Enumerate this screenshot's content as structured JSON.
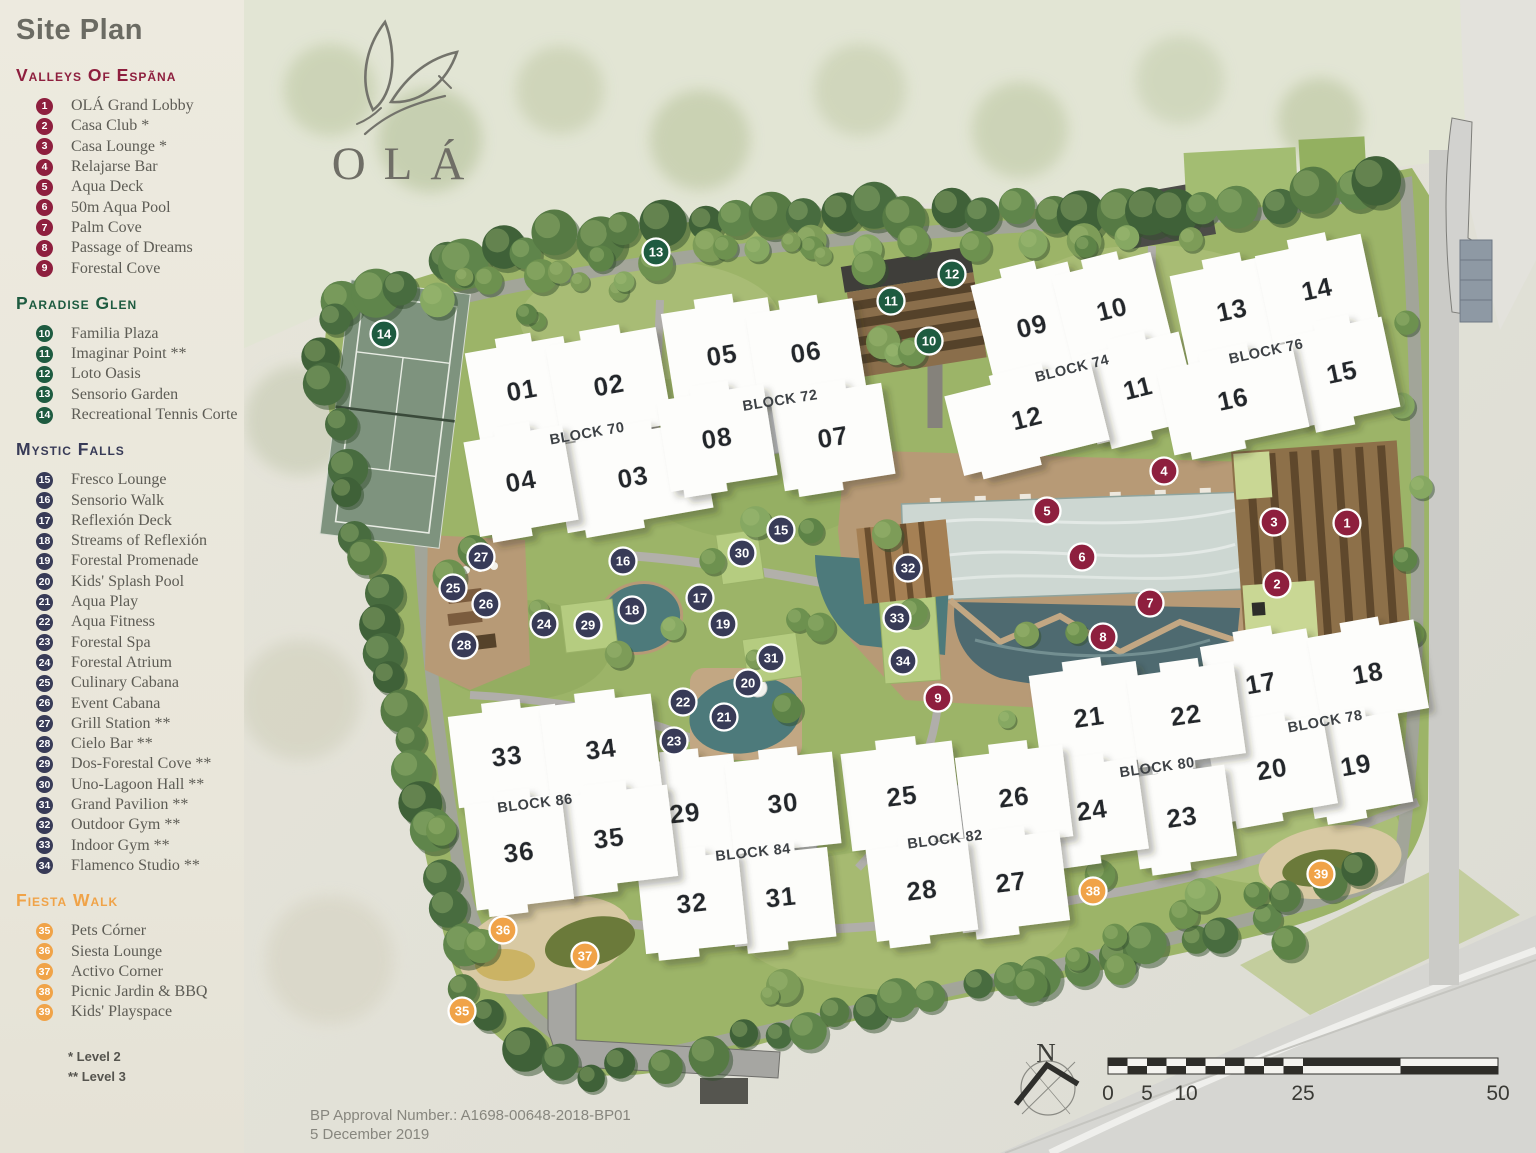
{
  "title": "Site Plan",
  "logo": {
    "name": "OLÁ"
  },
  "legend": {
    "sections": [
      {
        "id": "valleys",
        "title": "Valleys Of Espãna",
        "color": "#8e1f3e",
        "items": [
          {
            "n": "1",
            "label": "OLÁ Grand Lobby"
          },
          {
            "n": "2",
            "label": "Casa Club *"
          },
          {
            "n": "3",
            "label": "Casa Lounge *"
          },
          {
            "n": "4",
            "label": "Relajarse Bar"
          },
          {
            "n": "5",
            "label": "Aqua Deck"
          },
          {
            "n": "6",
            "label": "50m Aqua Pool"
          },
          {
            "n": "7",
            "label": "Palm Cove"
          },
          {
            "n": "8",
            "label": "Passage of Dreams"
          },
          {
            "n": "9",
            "label": "Forestal Cove"
          }
        ]
      },
      {
        "id": "paradise",
        "title": "Paradise Glen",
        "color": "#1e5b40",
        "items": [
          {
            "n": "10",
            "label": "Familia Plaza"
          },
          {
            "n": "11",
            "label": "Imaginar Point **"
          },
          {
            "n": "12",
            "label": "Loto Oasis"
          },
          {
            "n": "13",
            "label": "Sensorio Garden"
          },
          {
            "n": "14",
            "label": "Recreational Tennis Corte"
          }
        ]
      },
      {
        "id": "mystic",
        "title": "Mystic Falls",
        "color": "#383b57",
        "items": [
          {
            "n": "15",
            "label": "Fresco Lounge"
          },
          {
            "n": "16",
            "label": "Sensorio Walk"
          },
          {
            "n": "17",
            "label": "Reflexión Deck"
          },
          {
            "n": "18",
            "label": "Streams of Reflexión"
          },
          {
            "n": "19",
            "label": "Forestal Promenade"
          },
          {
            "n": "20",
            "label": "Kids' Splash Pool"
          },
          {
            "n": "21",
            "label": "Aqua Play"
          },
          {
            "n": "22",
            "label": "Aqua Fitness"
          },
          {
            "n": "23",
            "label": "Forestal Spa"
          },
          {
            "n": "24",
            "label": "Forestal Atrium"
          },
          {
            "n": "25",
            "label": "Culinary Cabana"
          },
          {
            "n": "26",
            "label": "Event Cabana"
          },
          {
            "n": "27",
            "label": "Grill Station **"
          },
          {
            "n": "28",
            "label": "Cielo Bar **"
          },
          {
            "n": "29",
            "label": "Dos-Forestal Cove **"
          },
          {
            "n": "30",
            "label": "Uno-Lagoon Hall **"
          },
          {
            "n": "31",
            "label": "Grand Pavilion **"
          },
          {
            "n": "32",
            "label": "Outdoor Gym **"
          },
          {
            "n": "33",
            "label": "Indoor Gym **"
          },
          {
            "n": "34",
            "label": "Flamenco Studio **"
          }
        ]
      },
      {
        "id": "fiesta",
        "title": "Fiesta Walk",
        "color": "#f0a348",
        "items": [
          {
            "n": "35",
            "label": "Pets Córner"
          },
          {
            "n": "36",
            "label": "Siesta Lounge"
          },
          {
            "n": "37",
            "label": "Activo Corner"
          },
          {
            "n": "38",
            "label": "Picnic Jardin & BBQ"
          },
          {
            "n": "39",
            "label": "Kids' Playspace"
          }
        ]
      }
    ],
    "footnotes": [
      "* Level 2",
      "** Level 3"
    ]
  },
  "map": {
    "blocks": [
      {
        "label": "BLOCK 70",
        "x": 587,
        "y": 433,
        "r": -10
      },
      {
        "label": "BLOCK 72",
        "x": 780,
        "y": 400,
        "r": -9
      },
      {
        "label": "BLOCK 74",
        "x": 1072,
        "y": 368,
        "r": -14
      },
      {
        "label": "BLOCK 76",
        "x": 1266,
        "y": 351,
        "r": -12
      },
      {
        "label": "BLOCK 78",
        "x": 1325,
        "y": 721,
        "r": -10
      },
      {
        "label": "BLOCK 80",
        "x": 1157,
        "y": 767,
        "r": -8
      },
      {
        "label": "BLOCK 82",
        "x": 945,
        "y": 839,
        "r": -7
      },
      {
        "label": "BLOCK 84",
        "x": 753,
        "y": 852,
        "r": -6
      },
      {
        "label": "BLOCK 86",
        "x": 535,
        "y": 803,
        "r": -7
      }
    ],
    "buildings": [
      {
        "n": "01",
        "x": 522,
        "y": 390,
        "w": 100,
        "h": 92,
        "r": -10
      },
      {
        "n": "02",
        "x": 609,
        "y": 385,
        "w": 112,
        "h": 98,
        "r": -10
      },
      {
        "n": "03",
        "x": 633,
        "y": 477,
        "w": 148,
        "h": 88,
        "r": -10
      },
      {
        "n": "04",
        "x": 521,
        "y": 481,
        "w": 100,
        "h": 96,
        "r": -10
      },
      {
        "n": "05",
        "x": 722,
        "y": 355,
        "w": 108,
        "h": 100,
        "r": -9
      },
      {
        "n": "06",
        "x": 806,
        "y": 352,
        "w": 108,
        "h": 92,
        "r": -9
      },
      {
        "n": "07",
        "x": 833,
        "y": 437,
        "w": 112,
        "h": 92,
        "r": -9
      },
      {
        "n": "08",
        "x": 717,
        "y": 438,
        "w": 108,
        "h": 92,
        "r": -9
      },
      {
        "n": "09",
        "x": 1032,
        "y": 326,
        "w": 100,
        "h": 108,
        "r": -14
      },
      {
        "n": "10",
        "x": 1112,
        "y": 309,
        "w": 102,
        "h": 92,
        "r": -14
      },
      {
        "n": "11",
        "x": 1138,
        "y": 388,
        "w": 106,
        "h": 90,
        "r": -14
      },
      {
        "n": "12",
        "x": 1027,
        "y": 418,
        "w": 150,
        "h": 82,
        "r": -14
      },
      {
        "n": "13",
        "x": 1232,
        "y": 310,
        "w": 108,
        "h": 92,
        "r": -12
      },
      {
        "n": "14",
        "x": 1317,
        "y": 289,
        "w": 108,
        "h": 90,
        "r": -12
      },
      {
        "n": "15",
        "x": 1342,
        "y": 372,
        "w": 100,
        "h": 92,
        "r": -12
      },
      {
        "n": "16",
        "x": 1233,
        "y": 399,
        "w": 138,
        "h": 86,
        "r": -12
      },
      {
        "n": "17",
        "x": 1261,
        "y": 683,
        "w": 108,
        "h": 92,
        "r": -10
      },
      {
        "n": "18",
        "x": 1368,
        "y": 673,
        "w": 108,
        "h": 90,
        "r": -10
      },
      {
        "n": "19",
        "x": 1356,
        "y": 765,
        "w": 100,
        "h": 92,
        "r": -10
      },
      {
        "n": "20",
        "x": 1272,
        "y": 769,
        "w": 118,
        "h": 90,
        "r": -10
      },
      {
        "n": "21",
        "x": 1089,
        "y": 717,
        "w": 108,
        "h": 98,
        "r": -8
      },
      {
        "n": "22",
        "x": 1186,
        "y": 715,
        "w": 108,
        "h": 92,
        "r": -8
      },
      {
        "n": "23",
        "x": 1182,
        "y": 817,
        "w": 98,
        "h": 92,
        "r": -8
      },
      {
        "n": "24",
        "x": 1092,
        "y": 810,
        "w": 102,
        "h": 92,
        "r": -8
      },
      {
        "n": "25",
        "x": 902,
        "y": 796,
        "w": 112,
        "h": 98,
        "r": -7
      },
      {
        "n": "26",
        "x": 1014,
        "y": 797,
        "w": 108,
        "h": 92,
        "r": -7
      },
      {
        "n": "27",
        "x": 1011,
        "y": 882,
        "w": 108,
        "h": 90,
        "r": -7
      },
      {
        "n": "28",
        "x": 922,
        "y": 890,
        "w": 102,
        "h": 92,
        "r": -7
      },
      {
        "n": "29",
        "x": 685,
        "y": 813,
        "w": 108,
        "h": 108,
        "r": -6
      },
      {
        "n": "30",
        "x": 783,
        "y": 803,
        "w": 108,
        "h": 92,
        "r": -6
      },
      {
        "n": "31",
        "x": 781,
        "y": 897,
        "w": 102,
        "h": 90,
        "r": -6
      },
      {
        "n": "32",
        "x": 692,
        "y": 903,
        "w": 102,
        "h": 92,
        "r": -6
      },
      {
        "n": "33",
        "x": 507,
        "y": 756,
        "w": 108,
        "h": 92,
        "r": -7
      },
      {
        "n": "34",
        "x": 601,
        "y": 749,
        "w": 112,
        "h": 98,
        "r": -7
      },
      {
        "n": "35",
        "x": 609,
        "y": 838,
        "w": 128,
        "h": 92,
        "r": -7
      },
      {
        "n": "36",
        "x": 519,
        "y": 852,
        "w": 98,
        "h": 106,
        "r": -7
      }
    ],
    "markers": [
      {
        "n": "1",
        "x": 1347,
        "y": 523,
        "c": "valleys"
      },
      {
        "n": "2",
        "x": 1277,
        "y": 584,
        "c": "valleys"
      },
      {
        "n": "3",
        "x": 1274,
        "y": 522,
        "c": "valleys"
      },
      {
        "n": "4",
        "x": 1164,
        "y": 471,
        "c": "valleys"
      },
      {
        "n": "5",
        "x": 1047,
        "y": 511,
        "c": "valleys"
      },
      {
        "n": "6",
        "x": 1082,
        "y": 557,
        "c": "valleys"
      },
      {
        "n": "7",
        "x": 1150,
        "y": 603,
        "c": "valleys"
      },
      {
        "n": "8",
        "x": 1103,
        "y": 637,
        "c": "valleys"
      },
      {
        "n": "9",
        "x": 938,
        "y": 698,
        "c": "valleys"
      },
      {
        "n": "10",
        "x": 929,
        "y": 341,
        "c": "paradise"
      },
      {
        "n": "11",
        "x": 891,
        "y": 301,
        "c": "paradise"
      },
      {
        "n": "12",
        "x": 952,
        "y": 274,
        "c": "paradise"
      },
      {
        "n": "13",
        "x": 656,
        "y": 252,
        "c": "paradise"
      },
      {
        "n": "14",
        "x": 384,
        "y": 334,
        "c": "paradise"
      },
      {
        "n": "15",
        "x": 781,
        "y": 530,
        "c": "mystic"
      },
      {
        "n": "16",
        "x": 623,
        "y": 561,
        "c": "mystic"
      },
      {
        "n": "17",
        "x": 700,
        "y": 598,
        "c": "mystic"
      },
      {
        "n": "18",
        "x": 632,
        "y": 610,
        "c": "mystic"
      },
      {
        "n": "19",
        "x": 723,
        "y": 624,
        "c": "mystic"
      },
      {
        "n": "20",
        "x": 748,
        "y": 683,
        "c": "mystic"
      },
      {
        "n": "21",
        "x": 724,
        "y": 717,
        "c": "mystic"
      },
      {
        "n": "22",
        "x": 683,
        "y": 702,
        "c": "mystic"
      },
      {
        "n": "23",
        "x": 674,
        "y": 741,
        "c": "mystic"
      },
      {
        "n": "24",
        "x": 544,
        "y": 624,
        "c": "mystic"
      },
      {
        "n": "25",
        "x": 453,
        "y": 588,
        "c": "mystic"
      },
      {
        "n": "26",
        "x": 486,
        "y": 604,
        "c": "mystic"
      },
      {
        "n": "27",
        "x": 481,
        "y": 557,
        "c": "mystic"
      },
      {
        "n": "28",
        "x": 464,
        "y": 645,
        "c": "mystic"
      },
      {
        "n": "29",
        "x": 588,
        "y": 625,
        "c": "mystic"
      },
      {
        "n": "30",
        "x": 742,
        "y": 553,
        "c": "mystic"
      },
      {
        "n": "31",
        "x": 771,
        "y": 658,
        "c": "mystic"
      },
      {
        "n": "32",
        "x": 908,
        "y": 568,
        "c": "mystic"
      },
      {
        "n": "33",
        "x": 897,
        "y": 618,
        "c": "mystic"
      },
      {
        "n": "34",
        "x": 903,
        "y": 661,
        "c": "mystic"
      },
      {
        "n": "35",
        "x": 462,
        "y": 1011,
        "c": "fiesta"
      },
      {
        "n": "36",
        "x": 503,
        "y": 930,
        "c": "fiesta"
      },
      {
        "n": "37",
        "x": 585,
        "y": 956,
        "c": "fiesta"
      },
      {
        "n": "38",
        "x": 1093,
        "y": 891,
        "c": "fiesta"
      },
      {
        "n": "39",
        "x": 1321,
        "y": 874,
        "c": "fiesta"
      }
    ]
  },
  "scalebar": {
    "labels": [
      "0",
      "5",
      "10",
      "25",
      "50"
    ]
  },
  "compass": {
    "label": "N"
  },
  "footer": {
    "approval": "BP Approval Number.: A1698-00648-2018-BP01",
    "date": "5 December 2019"
  }
}
